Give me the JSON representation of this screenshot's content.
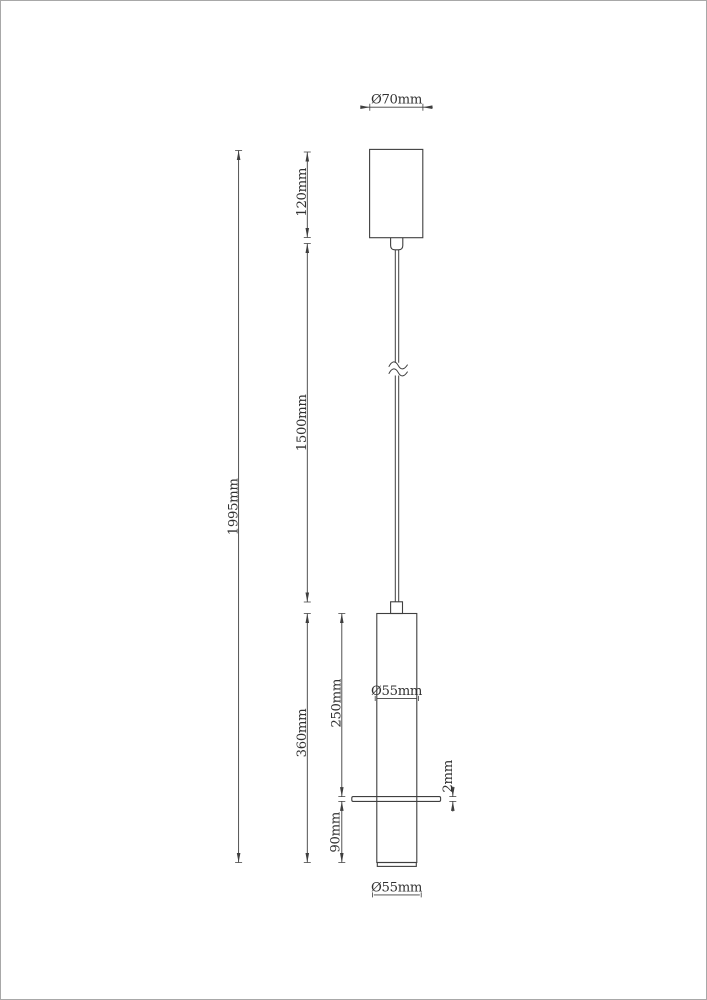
{
  "page": {
    "background": "#ffffff",
    "border_color": "#a8a8a8",
    "line_color": "#3f3f3f",
    "text_color": "#323232"
  },
  "drawing": {
    "type": "pendant-lamp-dimension-drawing",
    "labels": {
      "canopy_diameter": "Ø70mm",
      "canopy_height": "120mm",
      "total_height": "1995mm",
      "cable_length": "1500mm",
      "body_height": "360mm",
      "upper_body_height": "250mm",
      "lower_body_height": "90mm",
      "disc_thickness": "2mm",
      "body_diameter": "Ø55mm",
      "bottom_diameter": "Ø55mm"
    }
  }
}
